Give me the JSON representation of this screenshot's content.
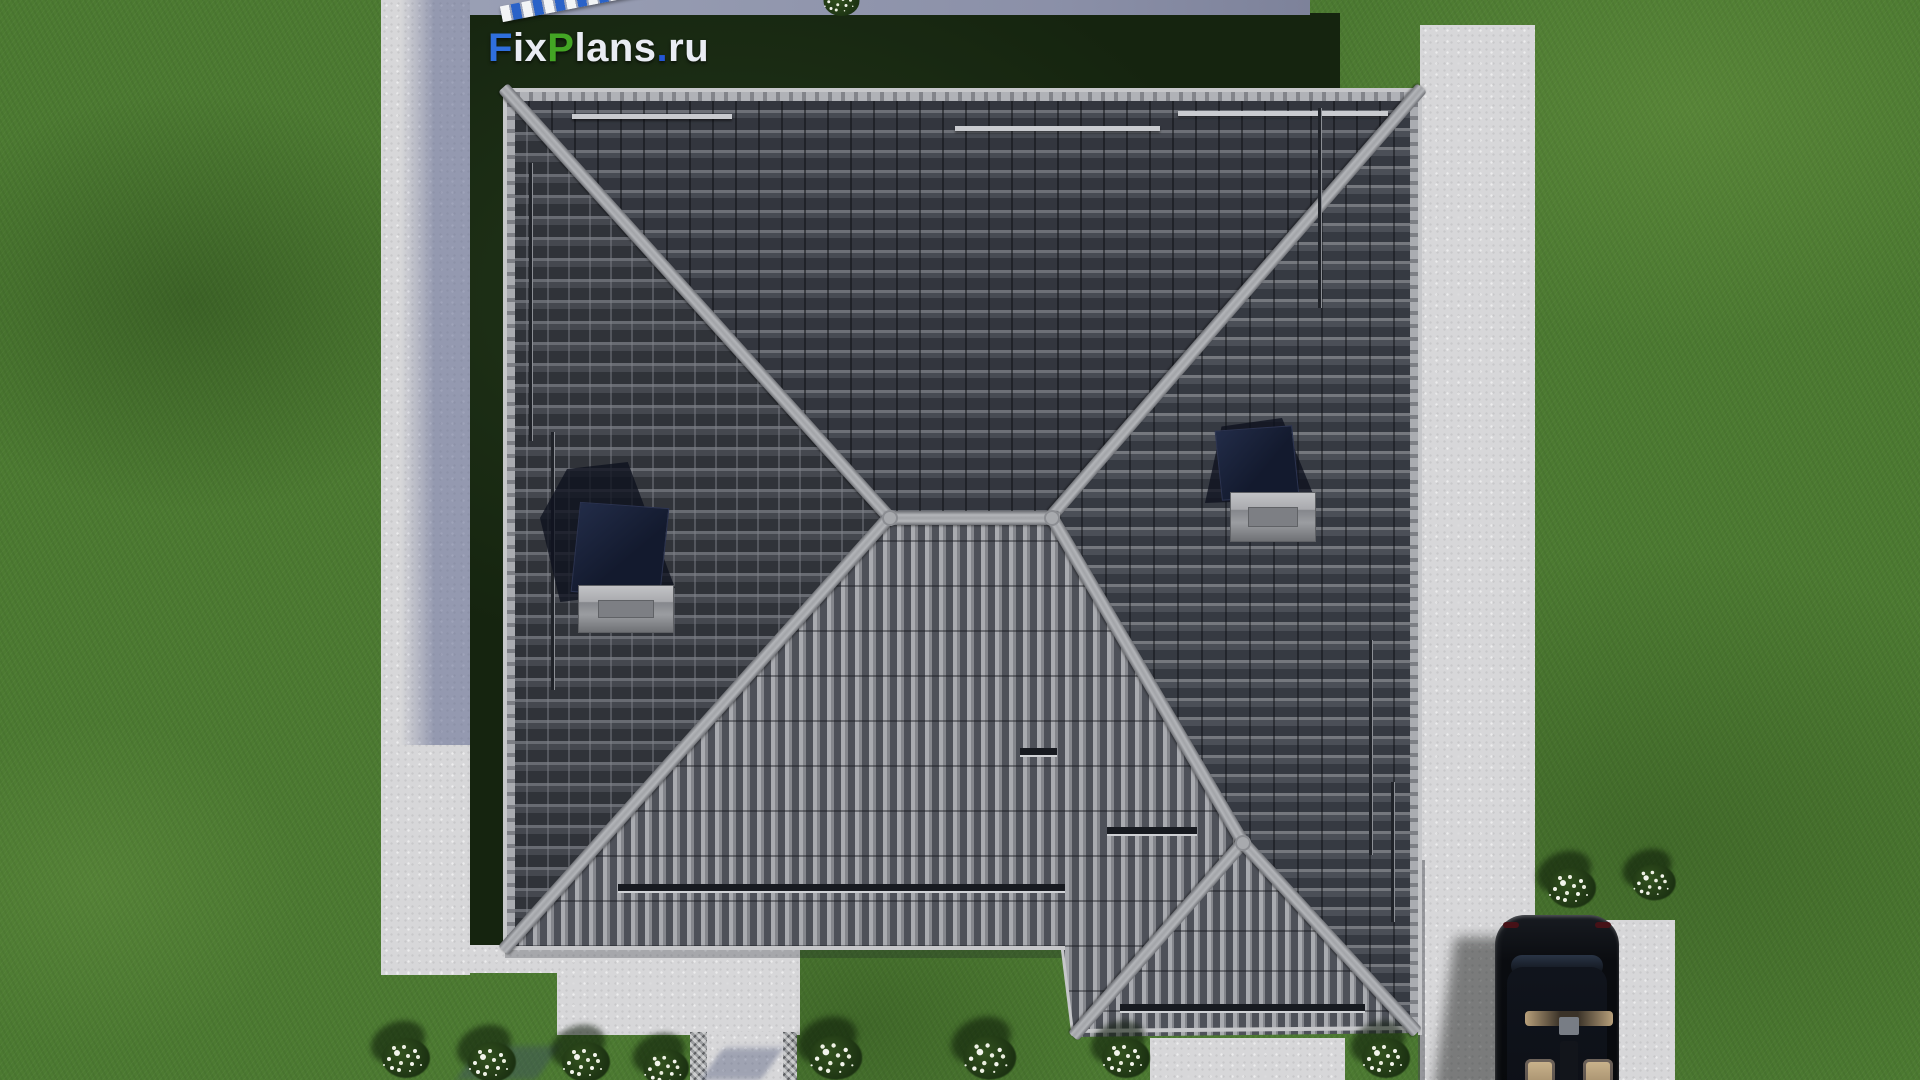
{
  "scene": {
    "title": "Aerial top view 3D render of a single-storey house with dark hip roof, FixPlans.ru project visualization",
    "view": "top-down roof plan render"
  },
  "watermark": {
    "full_text": "FixPlans.ru",
    "parts": [
      {
        "text": "F",
        "color": "#2f6fdd"
      },
      {
        "text": "ix",
        "color": "#e9ecf3"
      },
      {
        "text": "P",
        "color": "#43a524"
      },
      {
        "text": "lans",
        "color": "#e9ecf3"
      },
      {
        "text": ".",
        "color": "#2456d6"
      },
      {
        "text": "ru",
        "color": "#e9ecf3"
      }
    ]
  },
  "objects": {
    "roof": "hip roof with gray concrete tiles and ridge caps",
    "skylight_left": "roof window on west slope with cast shadow",
    "skylight_right": "roof window on east slope with cast shadow",
    "garage_roof": "lower hipped roof section over garage",
    "car": "black car parked on the driveway, top view, beige interior",
    "terrace": "concrete terrace behind the house",
    "walkway": "paved garden walkway with cobble borders",
    "driveway": "concrete pad below the garage roof",
    "left_path": "concrete sidewalk on the left",
    "right_path": "concrete sidewalk and parking pad on the right",
    "lawn": "green lawn",
    "bushes": "low shrubs with white flowers",
    "snow_guards": "snow guard bars on roof slopes"
  },
  "colors": {
    "lawn": "#4c7a31",
    "lawn_shadowed": "#15240f",
    "concrete": "#d7d7d9",
    "concrete_shadow": "#5c6590",
    "roof_tile_dark": "#34373f",
    "roof_tile_light": "#a9abb0",
    "ridge": "#a8aaae",
    "skylight_glass": "#131a2e",
    "car_body": "#0a0c10",
    "car_seats": "#cdb68f",
    "flowers": "#f3f5ec",
    "logo_blue": "#2f6fdd",
    "logo_green": "#43a524"
  }
}
